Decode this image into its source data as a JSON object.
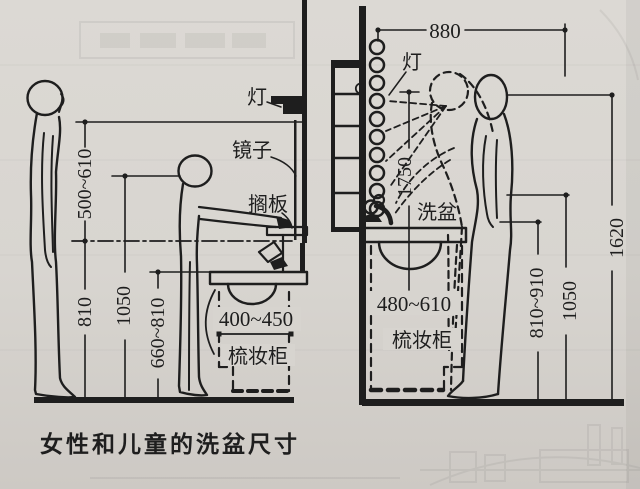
{
  "caption": "女性和儿童的洗盆尺寸",
  "left_diagram": {
    "labels": {
      "light": "灯",
      "mirror": "镜子",
      "shelf": "搁板",
      "cabinet": "梳妆柜"
    },
    "dimensions": {
      "eye_to_centerline": "500~610",
      "centerline_height": "810",
      "child_height": "1050",
      "child_basin_height": "660~810",
      "basin_depth": "400~450"
    }
  },
  "right_diagram": {
    "labels": {
      "light": "灯",
      "basin": "洗盆",
      "cabinet": "梳妆柜"
    },
    "dimensions": {
      "mirror_strip_width": "880",
      "mirror_height": "1750",
      "cabinet_depth": "480~610",
      "basin_rim_height": "810~910",
      "elbow_height": "1050",
      "eye_height": "1620"
    }
  },
  "colors": {
    "paper": "#d7d4cf",
    "ink": "#1e1e1e"
  }
}
